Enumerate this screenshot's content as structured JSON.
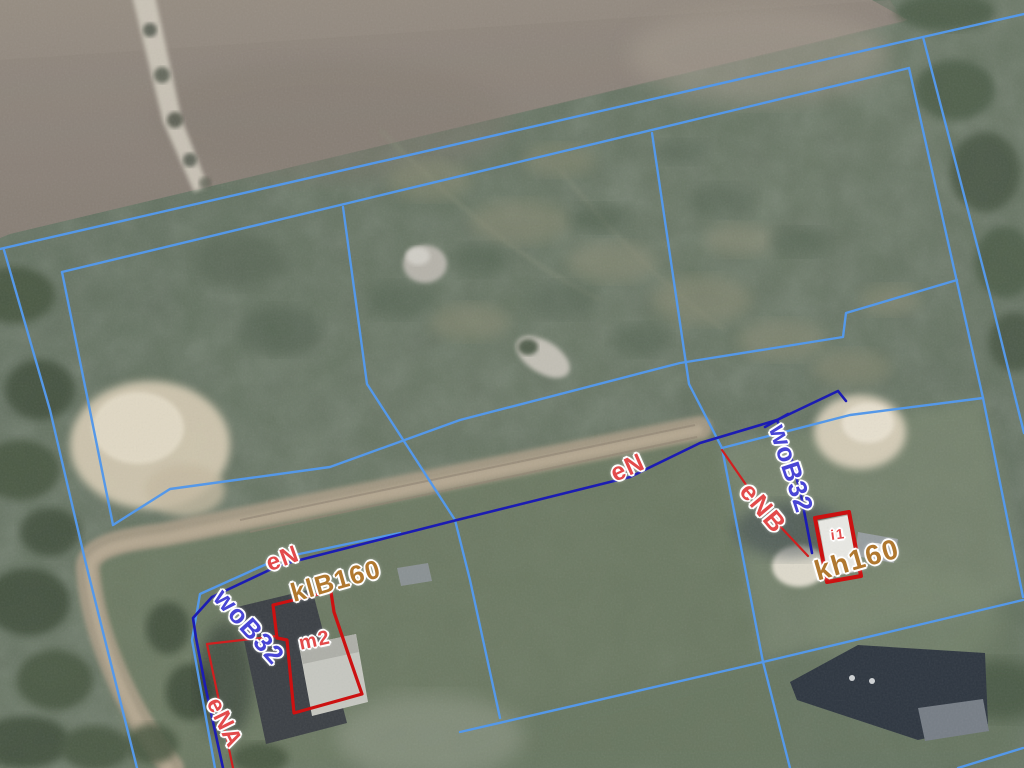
{
  "map": {
    "type": "cadastral-aerial-view",
    "colors": {
      "parcel_line": "#5598e8",
      "utility_line": "#1c1cb2",
      "connection_line": "#cf2020",
      "building_outline": "#cc1111",
      "label_red": "#e24b4b",
      "label_indigo": "#4946d4",
      "label_orange": "#b07830",
      "label_halo": "#ffffff"
    },
    "labels": [
      {
        "id": "eN-left",
        "text": "eN",
        "x": 283,
        "y": 559,
        "rot": -20,
        "size": 24,
        "color": "label_red"
      },
      {
        "id": "klB160",
        "text": "klB160",
        "x": 336,
        "y": 581,
        "rot": -16,
        "size": 26,
        "color": "label_orange"
      },
      {
        "id": "woB32-left",
        "text": "woB32",
        "x": 249,
        "y": 627,
        "rot": 48,
        "size": 26,
        "color": "label_indigo"
      },
      {
        "id": "eNA",
        "text": "eNA",
        "x": 224,
        "y": 723,
        "rot": 64,
        "size": 24,
        "color": "label_red"
      },
      {
        "id": "m2",
        "text": "m2",
        "x": 315,
        "y": 641,
        "rot": -12,
        "size": 20,
        "color": "label_red"
      },
      {
        "id": "eN-right",
        "text": "eN",
        "x": 628,
        "y": 468,
        "rot": -24,
        "size": 25,
        "color": "label_red"
      },
      {
        "id": "woB32-right",
        "text": "woB32",
        "x": 791,
        "y": 469,
        "rot": 72,
        "size": 26,
        "color": "label_indigo"
      },
      {
        "id": "eNB",
        "text": "eNB",
        "x": 763,
        "y": 508,
        "rot": 50,
        "size": 26,
        "color": "label_red"
      },
      {
        "id": "kh160",
        "text": "kh160",
        "x": 857,
        "y": 560,
        "rot": -16,
        "size": 28,
        "color": "label_orange"
      },
      {
        "id": "i1",
        "text": "i1",
        "x": 838,
        "y": 534,
        "rot": -8,
        "size": 14,
        "color": "label_red"
      }
    ],
    "layers": {
      "parcel_lines": [
        [
          [
            0,
            249
          ],
          [
            923,
            37
          ],
          [
            1024,
            14
          ]
        ],
        [
          [
            62,
            272
          ],
          [
            909,
            68
          ]
        ],
        [
          [
            4,
            250
          ],
          [
            50,
            410
          ],
          [
            85,
            560
          ],
          [
            137,
            768
          ]
        ],
        [
          [
            62,
            272
          ],
          [
            113,
            525
          ]
        ],
        [
          [
            113,
            525
          ],
          [
            170,
            489
          ],
          [
            330,
            467
          ],
          [
            460,
            420
          ],
          [
            680,
            363
          ],
          [
            843,
            337
          ],
          [
            846,
            313
          ],
          [
            957,
            280
          ]
        ],
        [
          [
            343,
            207
          ],
          [
            367,
            384
          ],
          [
            455,
            520
          ],
          [
            470,
            580
          ],
          [
            500,
            718
          ]
        ],
        [
          [
            652,
            133
          ],
          [
            689,
            384
          ],
          [
            722,
            448
          ],
          [
            763,
            662
          ],
          [
            790,
            768
          ]
        ],
        [
          [
            722,
            448
          ],
          [
            850,
            415
          ],
          [
            983,
            398
          ]
        ],
        [
          [
            909,
            68
          ],
          [
            983,
            398
          ],
          [
            1023,
            597
          ]
        ],
        [
          [
            923,
            37
          ],
          [
            990,
            295
          ],
          [
            1024,
            433
          ]
        ],
        [
          [
            460,
            732
          ],
          [
            763,
            662
          ],
          [
            1023,
            600
          ]
        ],
        [
          [
            958,
            768
          ],
          [
            1023,
            748
          ]
        ],
        [
          [
            215,
            768
          ],
          [
            192,
            640
          ],
          [
            200,
            594
          ],
          [
            280,
            558
          ],
          [
            400,
            533
          ]
        ]
      ],
      "utility_lines": [
        [
          [
            223,
            768
          ],
          [
            205,
            685
          ],
          [
            196,
            638
          ],
          [
            193,
            618
          ],
          [
            212,
            597
          ],
          [
            280,
            565
          ],
          [
            453,
            521
          ],
          [
            630,
            477
          ],
          [
            700,
            443
          ],
          [
            777,
            420
          ],
          [
            838,
            391
          ],
          [
            846,
            401
          ]
        ],
        [
          [
            777,
            420
          ],
          [
            791,
            457
          ],
          [
            801,
            495
          ],
          [
            812,
            553
          ]
        ],
        [
          [
            765,
            427
          ],
          [
            788,
            414
          ]
        ]
      ],
      "connection_lines": [
        [
          [
            722,
            450
          ],
          [
            760,
            505
          ],
          [
            808,
            556
          ]
        ],
        [
          [
            277,
            636
          ],
          [
            207,
            644
          ],
          [
            220,
            706
          ],
          [
            233,
            768
          ]
        ]
      ],
      "building_outlines": [
        [
          [
            273,
            605
          ],
          [
            327,
            592
          ],
          [
            331,
            592
          ],
          [
            334,
            612
          ],
          [
            352,
            665
          ],
          [
            362,
            694
          ],
          [
            294,
            713
          ],
          [
            287,
            640
          ],
          [
            277,
            638
          ]
        ],
        [
          [
            815,
            518
          ],
          [
            849,
            512
          ],
          [
            861,
            576
          ],
          [
            827,
            582
          ]
        ]
      ]
    }
  }
}
